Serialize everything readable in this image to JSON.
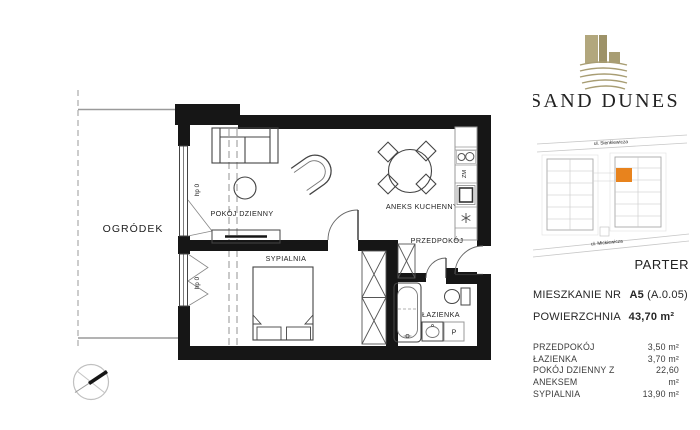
{
  "brand": {
    "name": "SAND DUNES",
    "logo_color": "#a89d73",
    "name_color": "#8d8577"
  },
  "floorplan": {
    "labels": {
      "garden": "OGRÓDEK",
      "living_room": "POKÓJ DZIENNY",
      "kitchen": "ANEKS KUCHENNY",
      "hallway": "PRZEDPOKÓJ",
      "bedroom": "SYPIALNIA",
      "bathroom": "ŁAZIENKA",
      "sill": "hp 0",
      "dishwasher": "ZM",
      "washing_machine": "P"
    }
  },
  "siteplan": {
    "street_top": "ul. Sienkiewicza",
    "street_bottom": "ul. Mickiewicza",
    "floor_label": "PARTER",
    "highlight_color": "#e8831d"
  },
  "details": {
    "apartment_label": "MIESZKANIE NR",
    "apartment_number": "A5",
    "apartment_code": "(A.0.05)",
    "area_label": "POWIERZCHNIA",
    "area_value": "43,70 m²",
    "rooms": [
      {
        "name": "PRZEDPOKÓJ",
        "area": "3,50 m²"
      },
      {
        "name": "ŁAZIENKA",
        "area": "3,70 m²"
      },
      {
        "name": "POKÓJ DZIENNY Z ANEKSEM",
        "area": "22,60 m²"
      },
      {
        "name": "SYPIALNIA",
        "area": "13,90 m²"
      }
    ]
  }
}
